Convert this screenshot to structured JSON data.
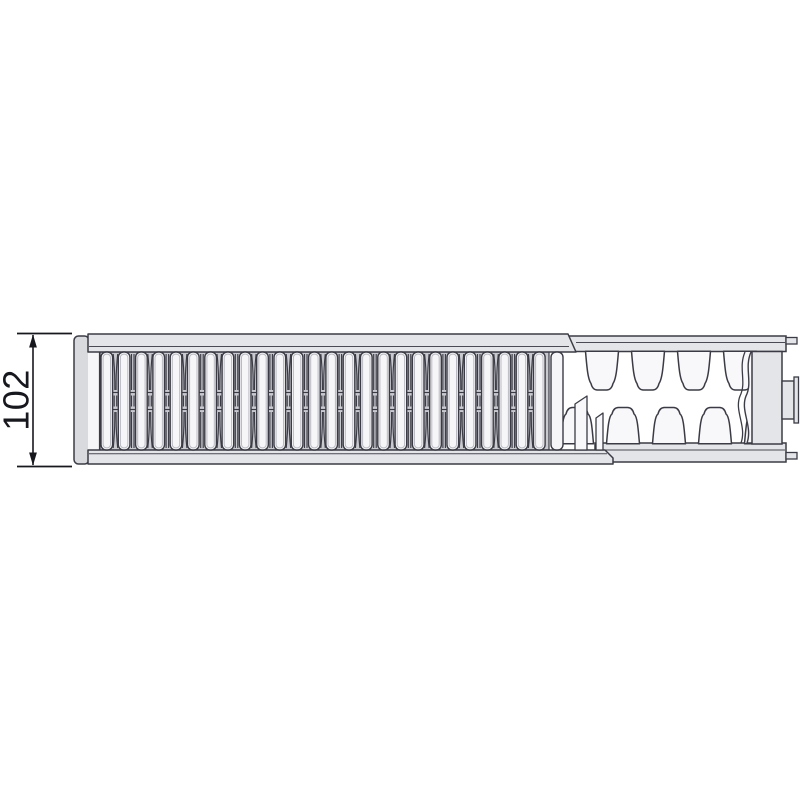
{
  "diagram": {
    "type": "technical-drawing",
    "subject": "panel radiator type 22 - horizontal top section view with cutaway showing convector fins",
    "dimension": {
      "label": "102",
      "orientation": "vertical",
      "measures": "radiator depth"
    },
    "colors": {
      "background": "#ffffff",
      "outline": "#3b3b45",
      "detail_line": "#4a4a54",
      "panel_fill": "#e4e5e9",
      "cap_fill": "#d9dade",
      "slat_fill": "#f6f6f8",
      "gap_bg": "#c9cad0",
      "fin_fill": "#f8f8fa",
      "inner_detail": "#b9bac2",
      "dim_color": "#17171e"
    },
    "grille": {
      "slat_count": 26,
      "extra_slat_count": 1,
      "gap_pattern_cycle": [
        "curved",
        "straight"
      ]
    },
    "fins": {
      "top_tooth_count": 4,
      "bottom_tooth_count": 5,
      "cut_edge_strip_count": 2
    },
    "connections": {
      "side_stub_count": 1,
      "rail_stub_count": 2
    }
  }
}
